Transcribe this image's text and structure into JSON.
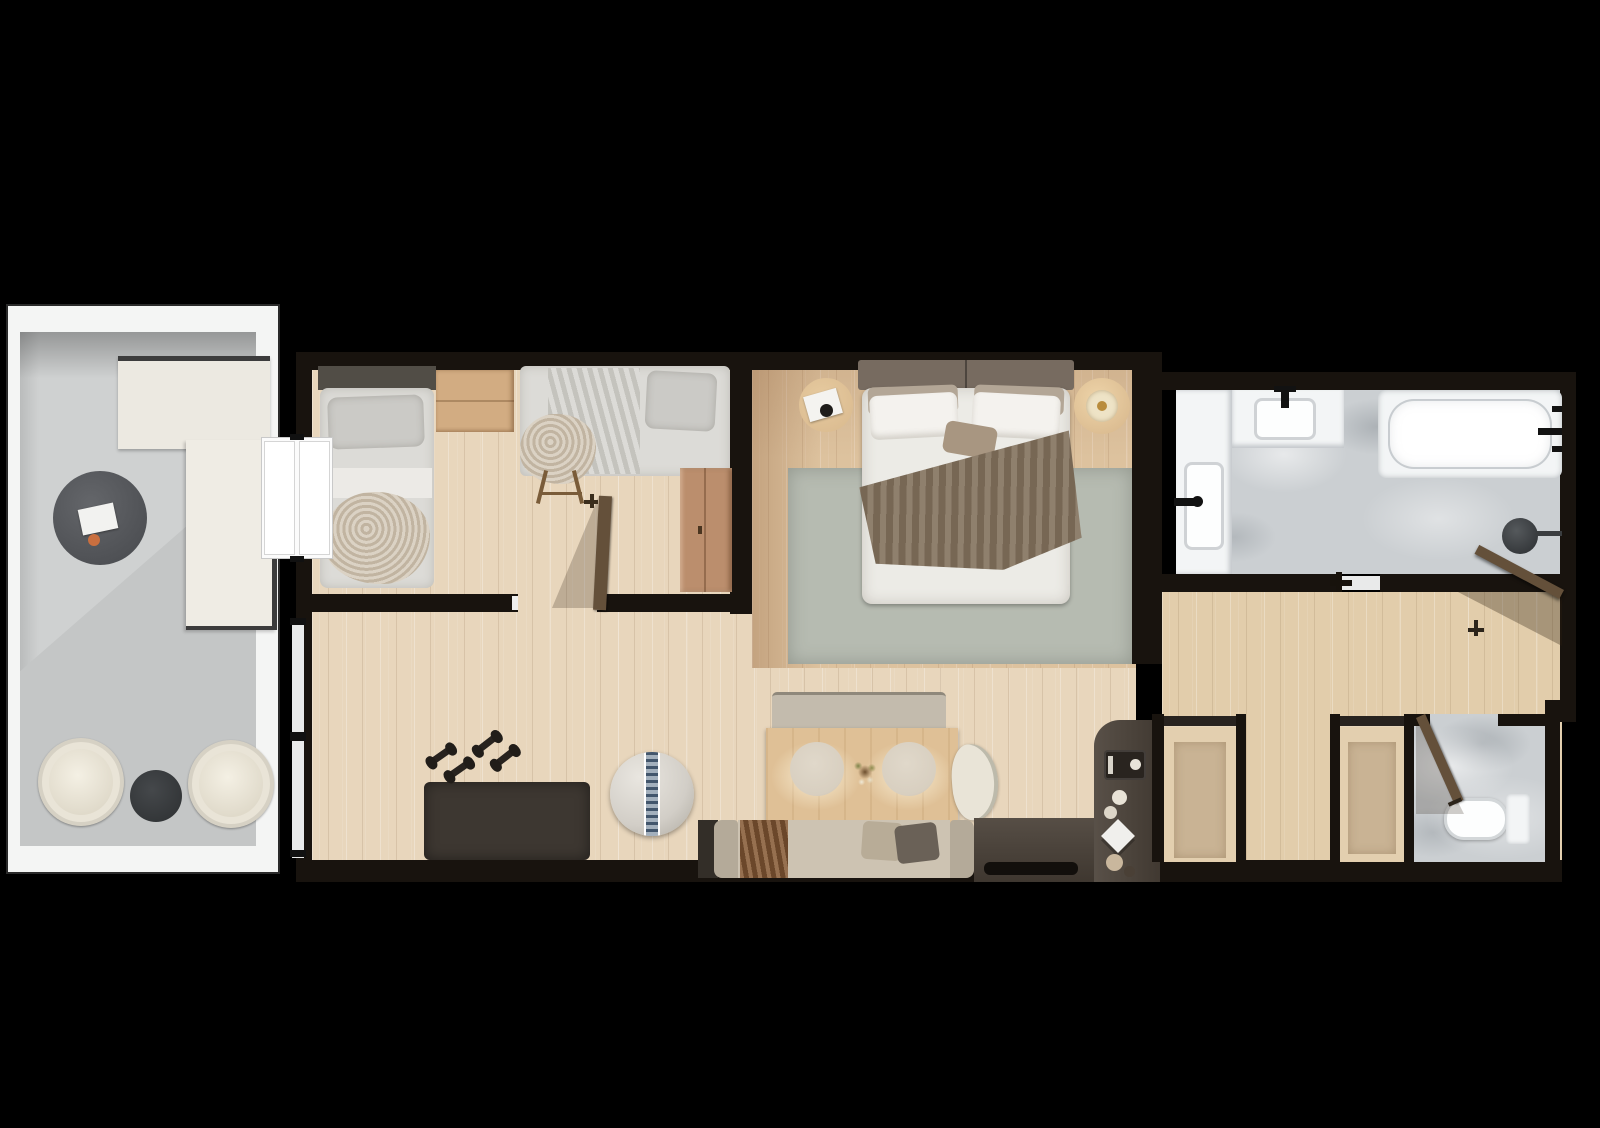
{
  "scene": {
    "type": "floor-plan-top-view",
    "visible_text": "none"
  },
  "palette": {
    "bg": "#000000",
    "wall": "#18130e",
    "woodA": "#e8d6bc",
    "woodB": "#e2cdab",
    "marble": "#cbcfd2",
    "fixtureWhite": "#f3f5f6",
    "railing": "#f4f5f4",
    "balconyFloor": "#cfd1d1",
    "balconyFloorDark": "#c4c6c6",
    "rug": "#b6bbb1",
    "duvet": "#ecebe6",
    "throw": "#84735f",
    "pillow": "#f4f2ee",
    "headboard": "#776b60",
    "mattress": "#dcdbd7",
    "headboard2": "#514d46",
    "blanketFluff": "#cfc3b0",
    "woodFurn": "#d2ac82",
    "wardrobe": "#bb8e6d",
    "doorWood": "#64503a",
    "doorWhite": "#fbfbfb",
    "sofaSeat": "#cdc3b2",
    "sofaArm": "#b4aa99",
    "throwBrown": "#7c5434",
    "pillowDark": "#6a6157",
    "tableWood": "#dfc096",
    "plate": "#d8cfc0",
    "benchGray": "#c3bbad",
    "matDark": "#3d3731",
    "metal": "#28231f",
    "ballBody": "#d2cec7",
    "ballStripe": "#93a2b2",
    "counter": "#4c433a",
    "counterDark": "#120f0c",
    "chairCream": "#e9e4d7",
    "tableDark": "#515456",
    "tableSmall": "#393c3e",
    "nightstand": "#dcbd92",
    "candle": "#eee3c6",
    "rugCloset": "#c9b394"
  },
  "rooms": [
    {
      "id": "balcony",
      "items": [
        "corner-sofa",
        "round-coffee-table",
        "serving-tray",
        "tub-armchair",
        "tub-armchair",
        "side-table"
      ]
    },
    {
      "id": "second-bedroom",
      "items": [
        "single-bed-left",
        "single-bed-right",
        "dresser",
        "chair-with-throw",
        "valet-stand",
        "wardrobe",
        "interior-door"
      ]
    },
    {
      "id": "master-bedroom",
      "items": [
        "double-bed",
        "nightstand-left",
        "nightstand-right",
        "area-rug",
        "tray",
        "candle"
      ]
    },
    {
      "id": "bathroom",
      "items": [
        "vanity-counter",
        "sink",
        "sink",
        "faucet",
        "faucet",
        "bathtub",
        "round-floor-fixture",
        "door-handle"
      ]
    },
    {
      "id": "living-kitchen",
      "items": [
        "window-strip",
        "exercise-mat",
        "dumbbells",
        "gym-ball",
        "dining-bench",
        "dining-table",
        "plate",
        "plate",
        "centerpiece",
        "dining-chair",
        "sofa",
        "throw-blanket",
        "cushion",
        "tv-console",
        "kitchen-peninsula",
        "coffee-machine",
        "cups",
        "napkin"
      ]
    },
    {
      "id": "hallway",
      "items": [
        "entry-door"
      ]
    },
    {
      "id": "closets",
      "items": [
        "clothes-rail-left-niche",
        "clothes-rail-right-niche",
        "closet-rug",
        "closet-rug"
      ]
    },
    {
      "id": "wc",
      "items": [
        "toilet",
        "wc-door"
      ]
    }
  ]
}
